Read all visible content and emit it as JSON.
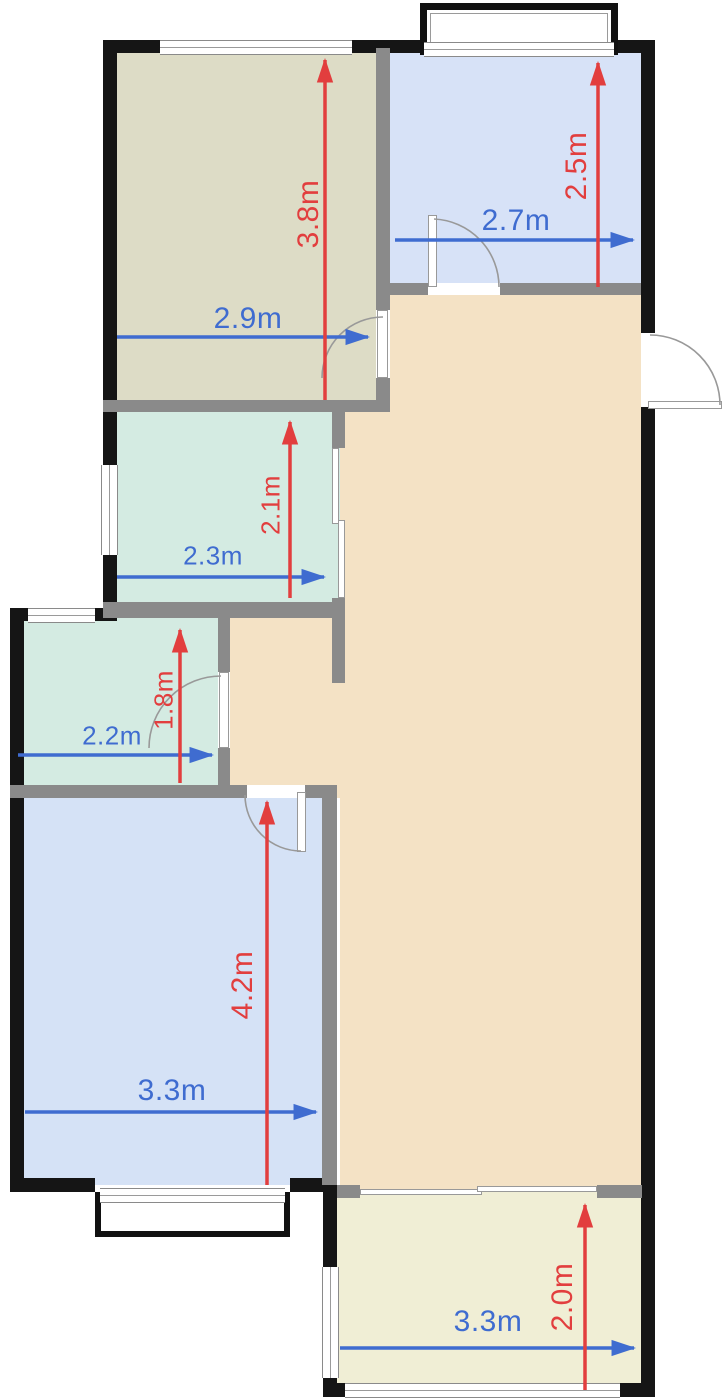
{
  "plan": {
    "unit": "m",
    "colors": {
      "dim_horizontal": "#3f6cd0",
      "dim_vertical": "#e23e3e",
      "wall_exterior": "#151515",
      "wall_interior": "#8a8a8a",
      "room_top_left": "#dddcc6",
      "room_top_right": "#d7e2f7",
      "room_mid_left": "#d4ebe2",
      "room_small_left": "#d4ebe2",
      "room_bottom_left": "#d5e2f6",
      "room_bottom_right": "#f0eed5",
      "hall": "#f4e2c5"
    },
    "rooms": [
      {
        "id": "top-left",
        "width_label": "2.9m",
        "depth_label": "3.8m"
      },
      {
        "id": "top-right",
        "width_label": "2.7m",
        "depth_label": "2.5m"
      },
      {
        "id": "mid-left",
        "width_label": "2.3m",
        "depth_label": "2.1m"
      },
      {
        "id": "small-left",
        "width_label": "2.2m",
        "depth_label": "1.8m"
      },
      {
        "id": "bottom-left",
        "width_label": "3.3m",
        "depth_label": "4.2m"
      },
      {
        "id": "bottom-right",
        "width_label": "3.3m",
        "depth_label": "2.0m"
      }
    ]
  }
}
